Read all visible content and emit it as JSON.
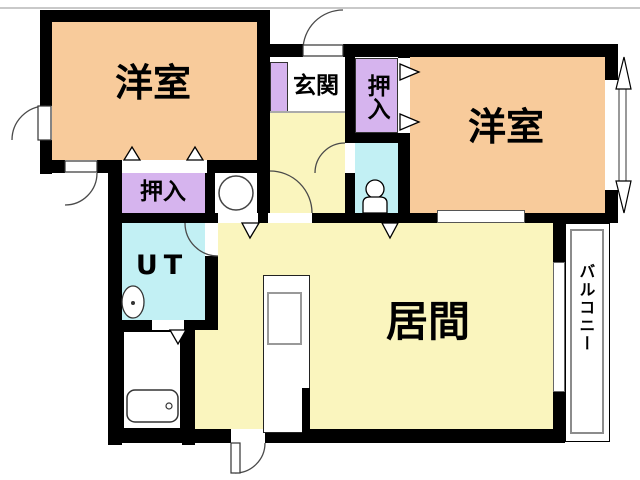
{
  "rooms": {
    "western_left": {
      "label": "洋室"
    },
    "western_right": {
      "label": "洋室"
    },
    "closet_left": {
      "label": "押入"
    },
    "closet_right": {
      "label": "押入"
    },
    "entrance": {
      "label": "玄関"
    },
    "utility": {
      "label": "UT"
    },
    "living": {
      "label": "居間"
    },
    "balcony": {
      "label": "バルコニー"
    }
  },
  "colors": {
    "wall": "#000000",
    "western_room": "#F8CB9B",
    "closet": "#D6B4EE",
    "wet_area": "#C2F0F4",
    "living_hall": "#FAF5BE",
    "floor_white": "#FFFFFF",
    "balcony_rail": "#8C8C8C"
  }
}
